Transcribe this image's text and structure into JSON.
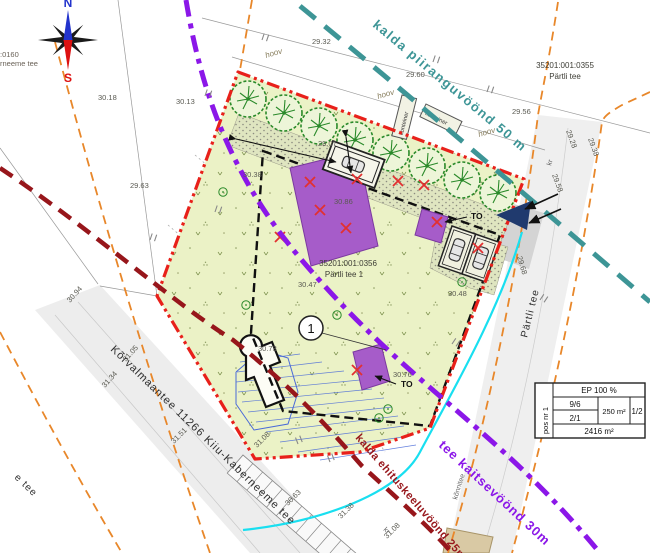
{
  "compass": {
    "north": "N",
    "south": "S"
  },
  "corner_text": {
    "line1": ":0160",
    "line2": "rneeme tee"
  },
  "parcels": {
    "main": {
      "cadastral": "35201:001:0356",
      "address": "Pärtli tee 1",
      "pos_number": "1"
    },
    "north_neighbor": {
      "cadastral": "35201:001:0355",
      "address": "Pärtli tee"
    }
  },
  "roads": {
    "main_road": "Kõrvalmaantee 11266 Kiiu-Kaberneeme tee",
    "main_road_cont": "e tee",
    "side_road": "Pärtli tee",
    "sidewalk": "kõnnitee",
    "ditch_abbr_1": "kr",
    "ditch_abbr_2": "kr"
  },
  "zones": {
    "shore_limit": {
      "label": "kalda piiranguvöönd 50 m",
      "color": "#3d9596"
    },
    "road_protection": {
      "label": "tee kaitsevöönd 30m",
      "color": "#8b17e8"
    },
    "shore_building_ban": {
      "label": "kalda ehituskeeluvöönd 25m",
      "color": "#97161b"
    }
  },
  "site": {
    "yard_labels": [
      "hoov",
      "hoov",
      "hoov"
    ],
    "container_labels": [
      "konteiner",
      "konteiner"
    ],
    "access_labels": [
      "TO",
      "TO"
    ]
  },
  "elevations": [
    "30.18",
    "30.13",
    "29.63",
    "30.38",
    "29.07",
    "30.86",
    "29.32",
    "29.60",
    "29.56",
    "29.28",
    "29.38",
    "29.58",
    "29.68",
    "30.48",
    "30.47",
    "30.73",
    "30.76",
    "30.94",
    "31.05",
    "31.34",
    "31.51",
    "31.08",
    "30.63",
    "31.38",
    "31.08"
  ],
  "info_table": {
    "pos": "pos nr 1",
    "build_rate": "EP 100 %",
    "storeys_main": "9/6",
    "storeys_sec": "2/1",
    "building_area": "250 m²",
    "ratio": "1/2",
    "plot_area": "2416 m²"
  },
  "colors": {
    "plot_fill": "#ebf2c6",
    "boundary_red": "#e8201a",
    "building_purple": "#a65cc9",
    "road_gray": "#ededed",
    "orange_boundary": "#e8872a",
    "cyan_utility": "#19dff0",
    "tree_green": "#2a8a2a",
    "north_blue": "#2233cc",
    "south_red": "#dd1111"
  }
}
